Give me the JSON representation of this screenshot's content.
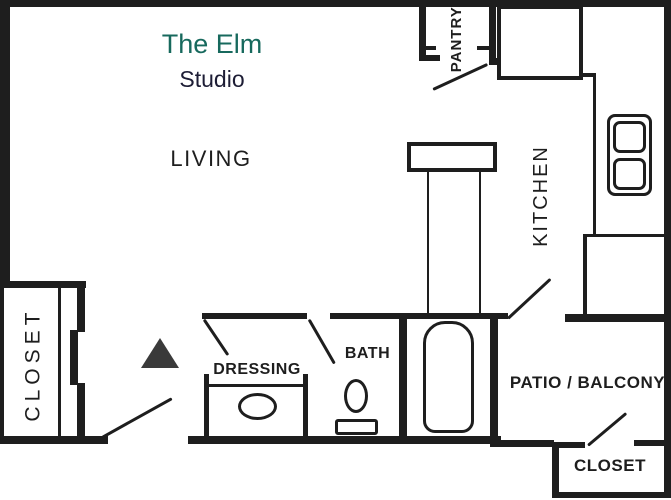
{
  "plan_title": {
    "name": "The Elm",
    "type": "Studio"
  },
  "rooms": {
    "living": "LIVING",
    "kitchen": "KITCHEN",
    "pantry": "PANTRY",
    "dressing": "DRESSING",
    "bath": "BATH",
    "patio": "PATIO / BALCONY",
    "entry_closet": "CLOSET",
    "patio_closet": "CLOSET"
  },
  "fixtures": {
    "refrigerator_box": "refrigerator-box",
    "breakfast_bar": "breakfast-bar-counter",
    "range": "range-cooktop-two-burners",
    "kitchen_counter": "kitchen-counter",
    "bathtub": "bathtub",
    "toilet": "toilet",
    "vanity_sink": "vanity-sink",
    "sliding_door": "sliding-closet-door",
    "entry_marker": "entry-marker-triangle"
  },
  "colors": {
    "title_green": "#17695d",
    "subtitle_navy": "#1d1d35",
    "ink": "#1e1e1e",
    "marker_gray": "#3a3a3a",
    "background": "#ffffff"
  }
}
